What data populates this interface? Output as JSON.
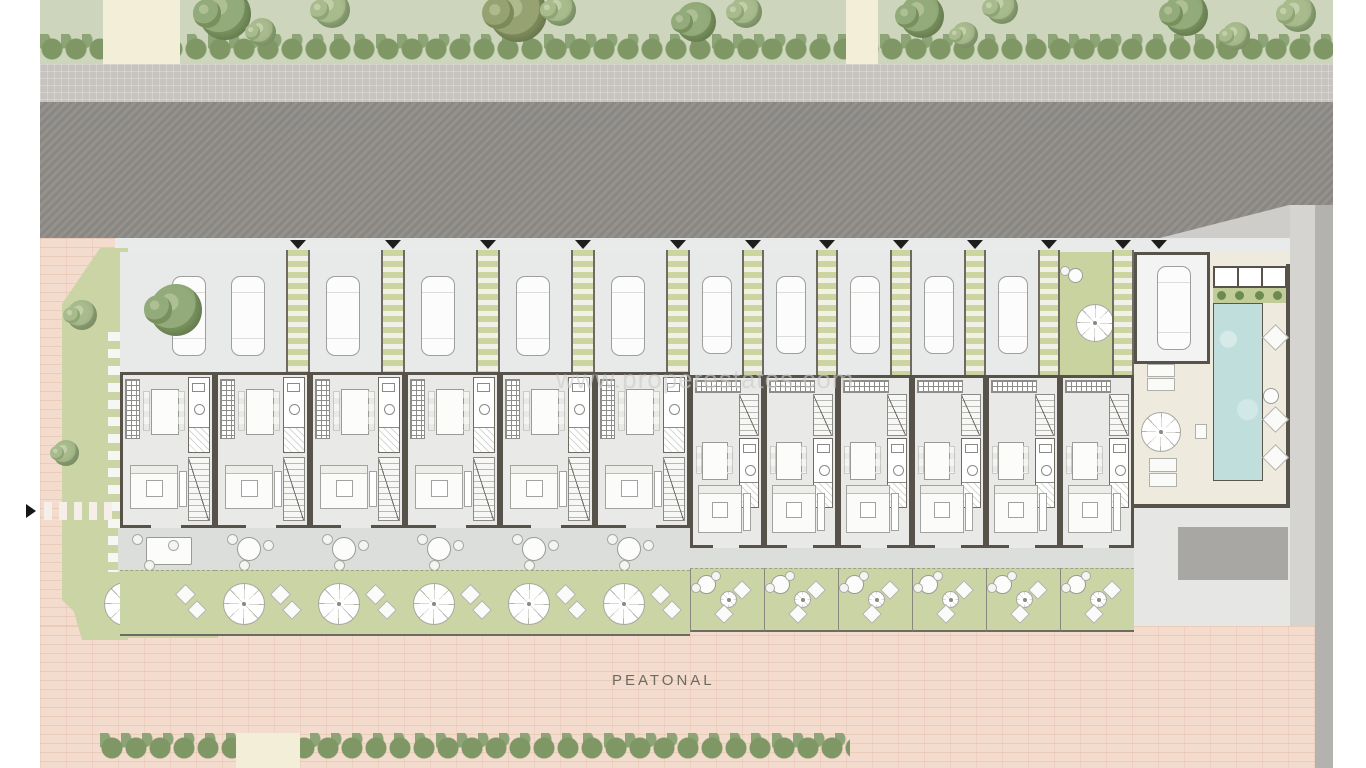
{
  "watermark": {
    "text": "www.properestates.com"
  },
  "labels": {
    "pedestrian_street": "PEATONAL"
  },
  "palette": {
    "background": "#ffffff",
    "road": "#8f8c88",
    "sidewalk": "#c7c4bf",
    "pedestrian_paving": "#f3dccd",
    "landscape_green": "#cdd6bd",
    "hedge_green": "#7f9765",
    "garden_green": "#cbd4a4",
    "path_cream": "#f2eed7",
    "pergola_green": "#ccd49f",
    "wall": "#57534b",
    "interior_floor": "#e9eae8",
    "terrace": "#dcdedc",
    "pool_water": "#c0dfdc",
    "pool_deck": "#efeade",
    "furniture": "#fbfbfa"
  },
  "site": {
    "units": [
      {
        "type": "A",
        "corner": true,
        "front": "parking"
      },
      {
        "type": "A",
        "corner": false,
        "front": "parking"
      },
      {
        "type": "A",
        "corner": false,
        "front": "parking"
      },
      {
        "type": "A",
        "corner": false,
        "front": "parking"
      },
      {
        "type": "A",
        "corner": false,
        "front": "parking"
      },
      {
        "type": "A",
        "corner": false,
        "front": "parking"
      },
      {
        "type": "B",
        "corner": false,
        "front": "parking"
      },
      {
        "type": "B",
        "corner": false,
        "front": "parking"
      },
      {
        "type": "B",
        "corner": false,
        "front": "parking"
      },
      {
        "type": "B",
        "corner": false,
        "front": "parking"
      },
      {
        "type": "B",
        "corner": false,
        "front": "parking"
      },
      {
        "type": "B",
        "corner": false,
        "front": "garden"
      },
      {
        "type": "garage",
        "corner": false,
        "front": "parking"
      }
    ],
    "entrance_markers": 12,
    "pool": {
      "present": true
    }
  }
}
